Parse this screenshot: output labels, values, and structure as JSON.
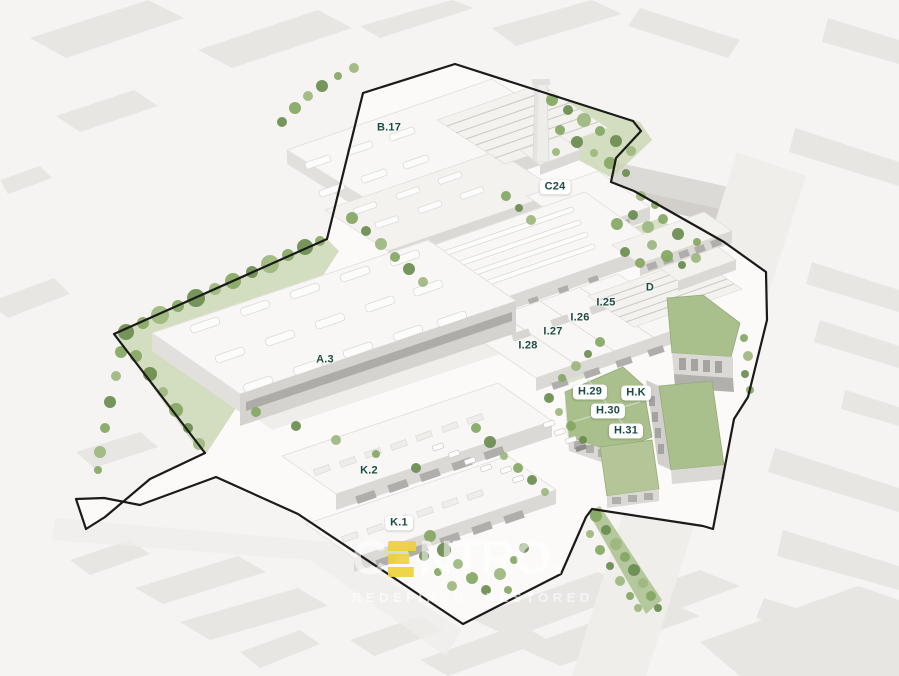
{
  "site_labels": {
    "b17": "B.17",
    "c24": "C24",
    "a3": "A.3",
    "i25": "I.25",
    "i26": "I.26",
    "i27": "I.27",
    "i28": "I.28",
    "d": "D",
    "h29": "H.29",
    "hk": "H.K",
    "h30": "H.30",
    "h31": "H.31",
    "k2": "K.2",
    "k1": "K.1"
  },
  "watermark": {
    "brand_prefix": "C",
    "brand_e": "E",
    "brand_suffix": "NTRO.",
    "tagline": "REDEFINED RESTORED"
  },
  "colors": {
    "label_text": "#1B4A41",
    "badge_bg": "#FFFFFF",
    "accent_yellow": "#EFD23C",
    "green_roof": "#A9BF8C",
    "lawn_green": "#C9D6B0",
    "tree_green": "#84A763",
    "tree_green_dark": "#6A8C4F",
    "tree_green_light": "#9CB77E",
    "boundary_line": "#1A1A19",
    "background": "#F5F4F2",
    "building_white": "#F8F7F5",
    "wall_gray": "#DBD9D5",
    "context_gray": "#E8E6E3",
    "road_gray": "#EFEEEB",
    "site_ground": "#FBFAF8"
  }
}
